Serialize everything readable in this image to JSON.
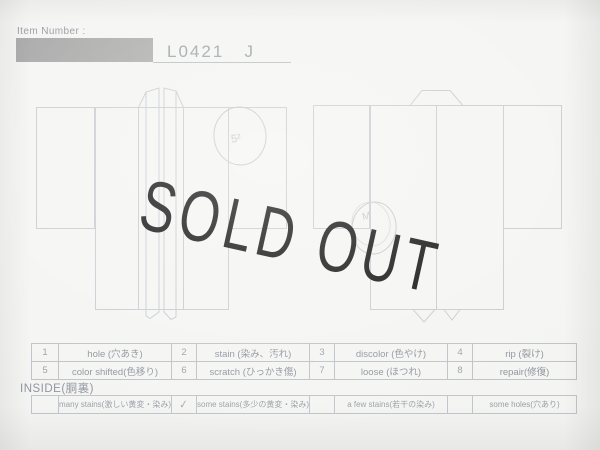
{
  "header": {
    "item_number_label": "Item Number :",
    "item_number_value": "L0421   J"
  },
  "overlay": {
    "text": "SOLD OUT",
    "color": "#0b0b0c"
  },
  "diagram": {
    "front_view_mark": "5²",
    "back_view_mark": "M"
  },
  "defect_table": {
    "rows": [
      {
        "cells": [
          {
            "num": "1",
            "label": "hole (穴あき)"
          },
          {
            "num": "2",
            "label": "stain (染み、汚れ)"
          },
          {
            "num": "3",
            "label": "discolor (色やけ)"
          },
          {
            "num": "4",
            "label": "rip (裂け)"
          }
        ]
      },
      {
        "cells": [
          {
            "num": "5",
            "label": "color shifted(色移り)"
          },
          {
            "num": "6",
            "label": "scratch (ひっかき傷)"
          },
          {
            "num": "7",
            "label": "loose (ほつれ)"
          },
          {
            "num": "8",
            "label": "repair(修復)"
          }
        ]
      }
    ]
  },
  "inside_section": {
    "title": "INSIDE(胴裏)",
    "options": [
      {
        "mark": "",
        "label": "many stains(激しい黄変・染み)"
      },
      {
        "mark": "✓",
        "label": "some stains(多少の黄変・染み)"
      },
      {
        "mark": "",
        "label": "a few stains(若干の染み)"
      },
      {
        "mark": "",
        "label": "some holes(穴あり)"
      }
    ]
  }
}
